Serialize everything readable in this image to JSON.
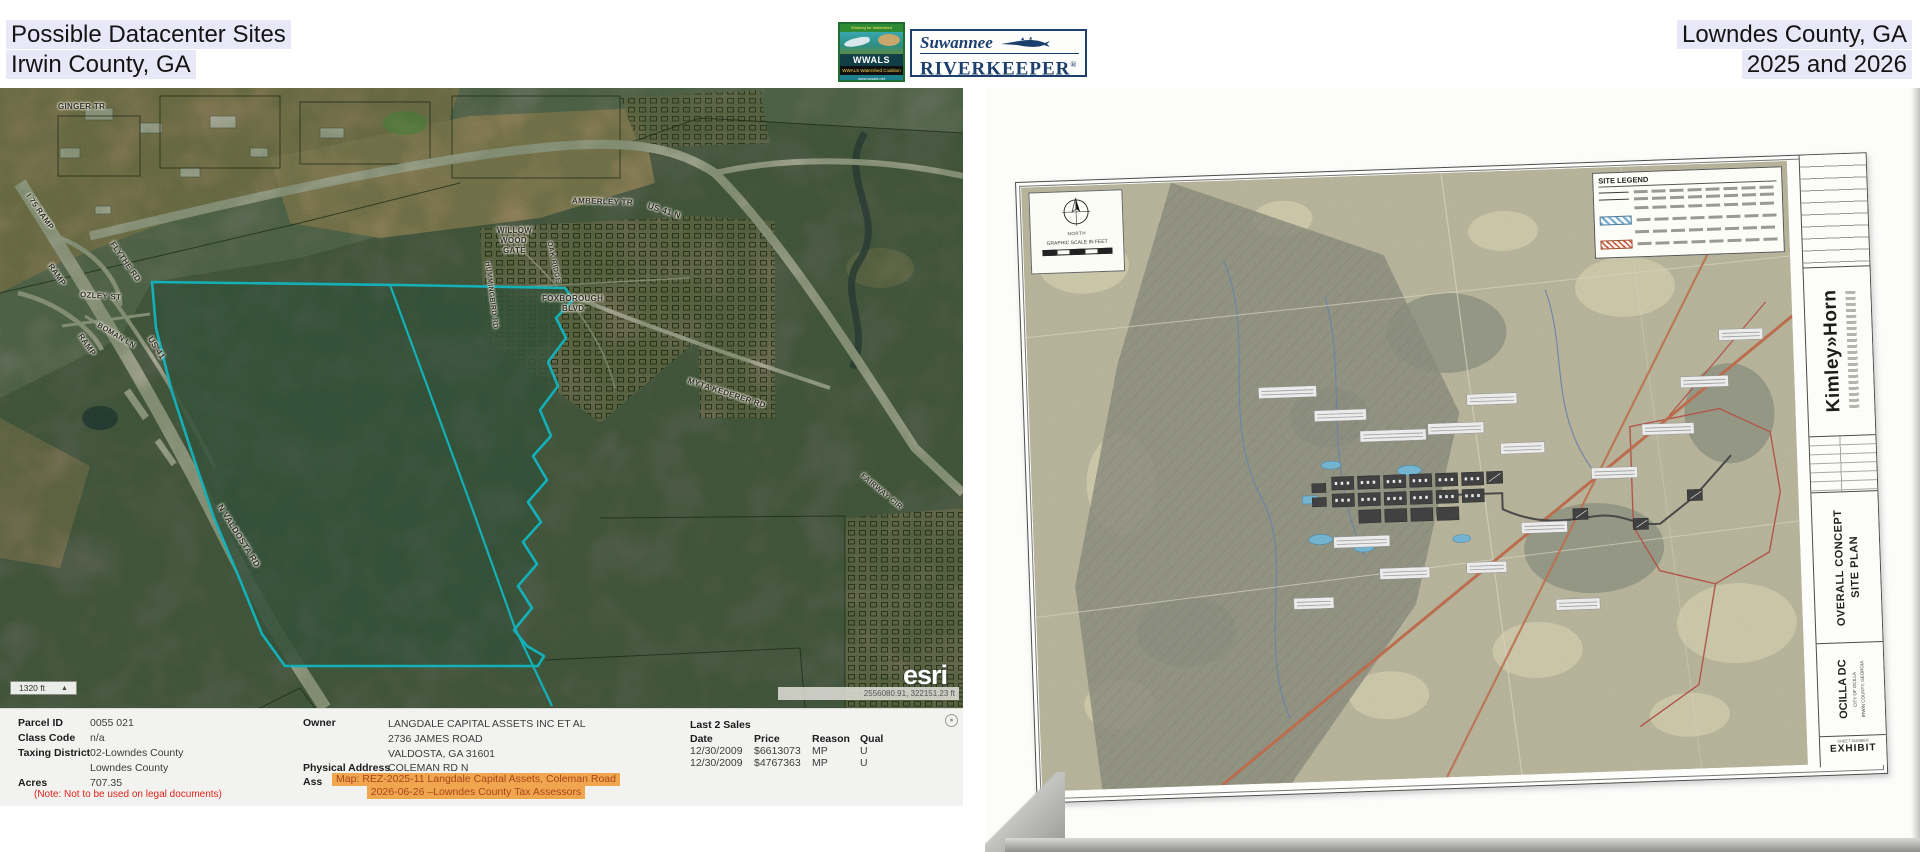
{
  "header": {
    "title_line1": "Possible Datacenter Sites",
    "title_line2": "Irwin County, GA",
    "right_line1": "Lowndes County, GA",
    "right_line2": "2025 and 2026"
  },
  "logos": {
    "wwals_top": "Working for Watershed Conservation",
    "wwals_name": "WWALS",
    "wwals_bottom": "WWALS Watershed Coalition",
    "wwals_url": "www.wwals.net",
    "riverkeeper_line1": "Suwannee",
    "riverkeeper_line2": "RIVERKEEPER",
    "registered_mark": "®"
  },
  "left_map": {
    "labels": [
      {
        "t": "GINGER TR",
        "x": 58,
        "y": 14,
        "r": 0,
        "s": 8
      },
      {
        "t": "I 75 RAMP",
        "x": 28,
        "y": 102,
        "r": 55,
        "s": 8
      },
      {
        "t": "RAMP",
        "x": 50,
        "y": 172,
        "r": 55,
        "s": 8
      },
      {
        "t": "RAMP",
        "x": 80,
        "y": 242,
        "r": 55,
        "s": 8
      },
      {
        "t": "FLYTHE RD",
        "x": 112,
        "y": 150,
        "r": 55,
        "s": 8
      },
      {
        "t": "OZLEY ST",
        "x": 80,
        "y": 202,
        "r": 4,
        "s": 8
      },
      {
        "t": "BOMAN LN",
        "x": 98,
        "y": 232,
        "r": 30,
        "s": 7.5
      },
      {
        "t": "US 41",
        "x": 150,
        "y": 244,
        "r": 58,
        "s": 8.5
      },
      {
        "t": "N VALDOSTA RD",
        "x": 220,
        "y": 412,
        "r": 58,
        "s": 8.5
      },
      {
        "t": "AMBERLEY TR",
        "x": 572,
        "y": 108,
        "r": 2,
        "s": 8
      },
      {
        "t": "US 41 N",
        "x": 648,
        "y": 112,
        "r": 18,
        "s": 8.5
      },
      {
        "t": "WILLOW",
        "x": 497,
        "y": 138,
        "r": 0,
        "s": 8
      },
      {
        "t": "WOOD",
        "x": 500,
        "y": 148,
        "r": 0,
        "s": 8
      },
      {
        "t": "GATE",
        "x": 503,
        "y": 158,
        "r": 0,
        "s": 8
      },
      {
        "t": "HUMMINGBIRD RD",
        "x": 487,
        "y": 170,
        "r": 83,
        "s": 7
      },
      {
        "t": "OAK RIDGE",
        "x": 549,
        "y": 150,
        "r": 78,
        "s": 7
      },
      {
        "t": "FOXBOROUGH",
        "x": 542,
        "y": 206,
        "r": 0,
        "s": 8
      },
      {
        "t": "BLVD",
        "x": 562,
        "y": 216,
        "r": 0,
        "s": 8
      },
      {
        "t": "MYTA KEDERER RD",
        "x": 688,
        "y": 288,
        "r": 18,
        "s": 8
      },
      {
        "t": "FAIRWAY CIR",
        "x": 862,
        "y": 382,
        "r": 40,
        "s": 7.5
      }
    ],
    "scale_label": "1320 ft",
    "north_glyph": "▲",
    "esri_label": "esri",
    "coordinates": "2556080.91, 322151.23 ft"
  },
  "parcel_panel": {
    "left_rows": [
      [
        "Parcel ID",
        "0055 021"
      ],
      [
        "Class Code",
        "n/a"
      ],
      [
        "Taxing District",
        "02-Lowndes County"
      ],
      [
        "",
        "Lowndes County"
      ],
      [
        "Acres",
        "707.35"
      ]
    ],
    "note": "(Note: Not to be used on legal documents)",
    "owner_label": "Owner",
    "owner_lines": [
      "LANGDALE CAPITAL ASSETS INC ET AL",
      "2736 JAMES ROAD",
      "VALDOSTA, GA 31601"
    ],
    "physical_label": "Physical Address",
    "physical_value": "COLEMAN RD N",
    "assessed_label": "Ass",
    "highlight_lines": [
      "Map: REZ-2025-11 Langdale Capital Assets, Coleman Road",
      "2026-06-26 –Lowndes County Tax Assessors"
    ],
    "sales_title": "Last 2 Sales",
    "sales_headers": [
      "Date",
      "Price",
      "Reason",
      "Qual"
    ],
    "sales_rows": [
      [
        "12/30/2009",
        "$6613073",
        "MP",
        "U"
      ],
      [
        "12/30/2009",
        "$4767363",
        "MP",
        "U"
      ]
    ]
  },
  "site_plan": {
    "north_label": "NORTH",
    "scale_caption": "GRAPHIC SCALE IN FEET",
    "legend_title": "SITE LEGEND",
    "legend_rows": [
      "line",
      "line",
      "note",
      "hatch-blue",
      "note",
      "hatch-red"
    ],
    "firm_name": "Kimley»Horn",
    "title_line1": "OVERALL CONCEPT",
    "title_line2": "SITE PLAN",
    "project_name": "OCILLA DC",
    "project_sub1": "CITY OF OCILLA",
    "project_sub2": "IRWIN COUNTY, GEORGIA",
    "sheet_label": "SHEET NUMBER",
    "exhibit_label": "EXHIBIT"
  },
  "colors": {
    "parcel_outline_cyan": "#17ccd5",
    "highlight_orange": "#f0a64f",
    "highlight_text": "#a9451b",
    "note_red": "#e2231a",
    "header_highlight": "#e8e8f8",
    "plan_line_orange": "#c05a30",
    "riverkeeper_navy": "#1c3f6e"
  }
}
